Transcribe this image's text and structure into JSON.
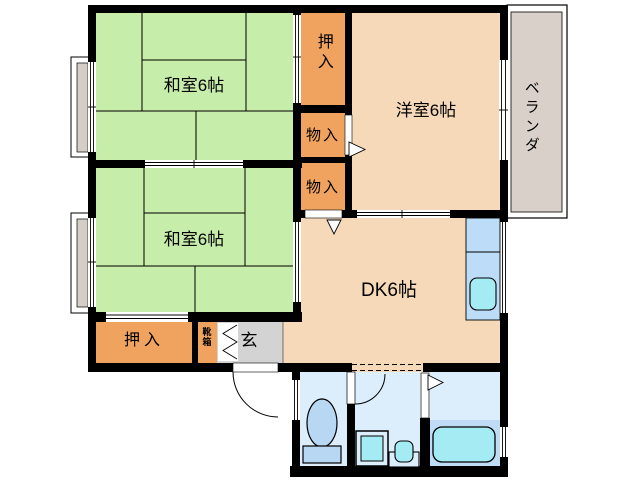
{
  "title": "2DK apartment floor plan",
  "rooms": {
    "washitsu1": {
      "label": "和室6帖",
      "color": "#c6eda9"
    },
    "washitsu2": {
      "label": "和室6帖",
      "color": "#c6eda9"
    },
    "yoshitsu": {
      "label": "洋室6帖",
      "color": "#f5d9b8"
    },
    "dk": {
      "label": "DK6帖",
      "color": "#f5d9b8"
    },
    "oshiire_top": {
      "label": "押入",
      "color": "#f0a35f"
    },
    "monoire1": {
      "label": "物入",
      "color": "#f0a35f"
    },
    "monoire2": {
      "label": "物入",
      "color": "#f0a35f"
    },
    "oshiire_bottom": {
      "label": "押入",
      "color": "#f0a35f"
    },
    "kutsubako": {
      "label": "靴箱",
      "color": "#f0a35f"
    },
    "genkan": {
      "label": "玄",
      "color": "#d3d3d3"
    },
    "veranda": {
      "label": "ベランダ",
      "color": "#d9d1c9"
    }
  },
  "fixtures": [
    "kitchen-sink",
    "toilet",
    "washing-machine",
    "washbasin",
    "bathtub"
  ],
  "colors": {
    "wall": "#000000",
    "tatami_green": "#c6eda9",
    "closet_orange": "#f0a35f",
    "room_tan": "#f5d9b8",
    "water_floor": "#dcedfc",
    "bath_lower_floor": "#bfdbf5",
    "kitchen_counter": "#bcdcf8",
    "fixture_cyan": "#a5ebf3",
    "fixture_blue": "#b7d7f3",
    "genkan_gray": "#d3d3d3",
    "veranda_gray": "#d9d1c9",
    "window_sill": "#d5cec6"
  }
}
